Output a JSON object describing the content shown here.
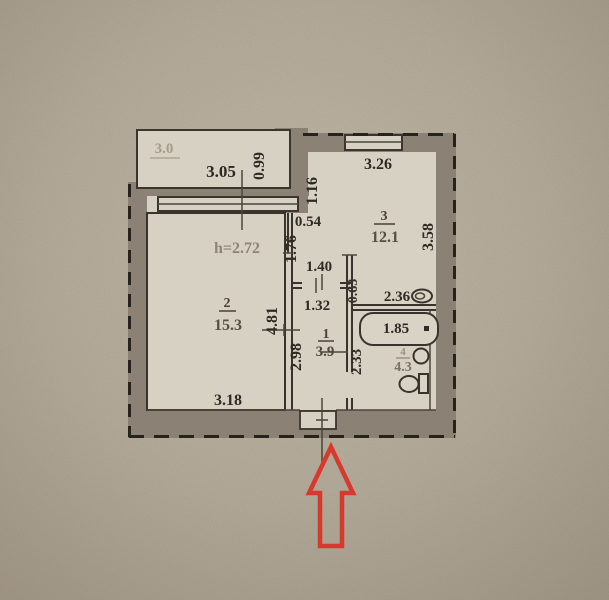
{
  "plan": {
    "balcony": {
      "area": "3.0",
      "width_dim": "3.05",
      "depth_dim": "0.99"
    },
    "living_room": {
      "number": "2",
      "area": "15.3",
      "ceiling_height": "h=2.72",
      "side_dim": "4.81",
      "bottom_dim": "3.18"
    },
    "kitchen": {
      "number": "3",
      "area": "12.1",
      "top_dim": "3.26",
      "left_dim": "1.16",
      "right_dim": "3.58",
      "bottom_dim": "2.36",
      "entry_dim": "1.40",
      "duct_width_dim": "0.54",
      "duct_length_dim": "1.76",
      "wall_segment_dim": "0.63"
    },
    "hallway": {
      "number": "1",
      "area": "3.9",
      "width_dim": "1.32",
      "length_dim": "2.98"
    },
    "bathroom": {
      "number": "4",
      "area": "4.3",
      "side_dim": "2.33",
      "tub_dim": "1.85",
      "tub_dot": "."
    }
  },
  "colors": {
    "arrow_red": "#d63a2e",
    "wall_gray": "#8b8174",
    "ink": "#332e27",
    "paper": "#c3baa9",
    "room_fill": "#d7d1c3"
  }
}
